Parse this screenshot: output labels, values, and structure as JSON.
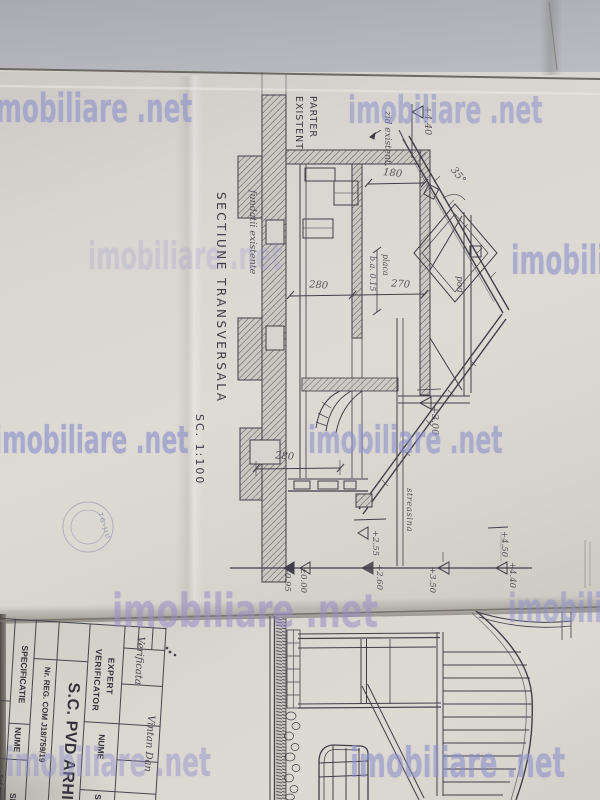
{
  "watermark": {
    "site": "imobiliare .net",
    "partial_left": "mobiliare .net",
    "color": "#8d8fcb"
  },
  "section": {
    "title": "SECTIUNE TRANSVERSALA",
    "scale": "SC. 1:100",
    "labels": {
      "parter": "PARTER",
      "existent": "EXISTENT",
      "zid": "zid existent.",
      "fundatii": "fundatii existente",
      "pod": "pod",
      "placa": "placa",
      "placa_dim": "b.a. 0.15",
      "streasina": "streasina",
      "angle": "35°"
    },
    "levels": {
      "l_440": "+4.40",
      "l_300": "+3.00",
      "l_095": "-0.95",
      "l_000": "±0.00",
      "l_255": "+2.55",
      "l_260": "+2.60",
      "l_350": "+3.50",
      "l_450": "+4.50",
      "l_440b": "+4.40"
    },
    "dims": {
      "d180": "180",
      "d280": "280",
      "d270": "270",
      "d280b": "280"
    }
  },
  "titleblock": {
    "verificator": "VERIFICATOR",
    "expert": "EXPERT",
    "nume": "NUME",
    "semnatura": "SEMNAT.",
    "company": "S.C. PVD ARHIT",
    "reg": "Nr. REG. COM J18/759/19",
    "specificatie": "SPECIFICATIE",
    "nume2": "NUME",
    "semnatura2": "SE",
    "sef": "Sef proiect",
    "sign1": "Verificata",
    "sign2": "Vintan Dan"
  },
  "stamp": {
    "text": "TG-JIU"
  }
}
